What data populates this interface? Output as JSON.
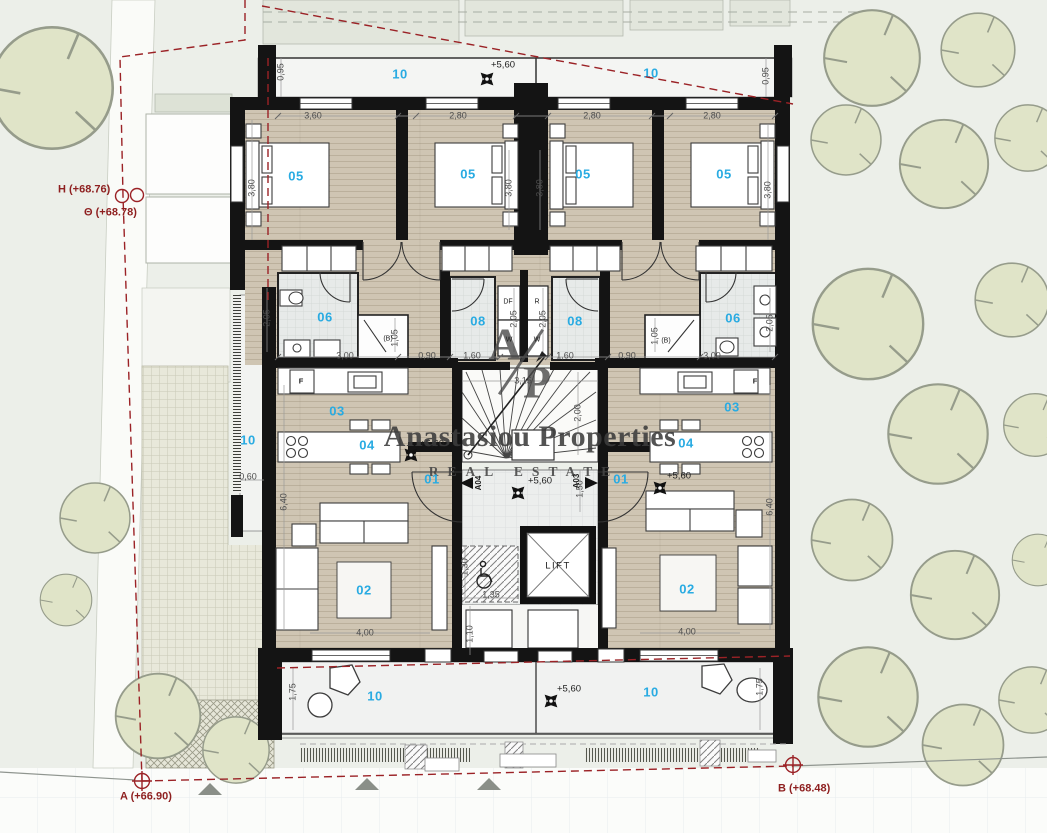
{
  "watermark": {
    "title": "Anastasiou Properties",
    "subtitle": "REAL ESTATE",
    "monogram_a": "A",
    "monogram_p": "P"
  },
  "boundary_markers": {
    "h": "H (+68.76)",
    "theta": "Θ (+68.78)",
    "a": "A (+66.90)",
    "b": "B (+68.48)"
  },
  "levels": {
    "plus560": "+5,60"
  },
  "rooms": {
    "entry": "01",
    "living": "02",
    "kitchen": "03",
    "dining": "04",
    "bedroom": "05",
    "bath": "06",
    "bath2": "08",
    "balcony": "10"
  },
  "doors": {
    "left": "A04",
    "right": "A03"
  },
  "lift_label": "LIFT",
  "appliances": {
    "fridge": "F",
    "df": "DF",
    "washer": "W",
    "dryer": "R",
    "boiler": "(B)"
  },
  "dims": {
    "d060": "0,60",
    "d090": "0,90",
    "d095": "0,95",
    "d105": "1,05",
    "d110": "1,10",
    "d130": "1,30",
    "d135": "1,35",
    "d150": "1,50",
    "d160": "1,60",
    "d175": "1,75",
    "d200": "2,00",
    "d205": "2,05",
    "d280": "2,80",
    "d300": "3,00",
    "d315": "3,15",
    "d360": "3,60",
    "d380": "3,80",
    "d400": "4,00",
    "d640": "6,40"
  },
  "colors": {
    "accent_cyan": "#29abe2",
    "boundary_red": "#9b2226",
    "wall_black": "#161616",
    "wood_floor": "#cfc5b3",
    "tile_grey": "#e7eae9",
    "site_green": "#ecefe9",
    "tree_fill": "#e0e4c8"
  }
}
